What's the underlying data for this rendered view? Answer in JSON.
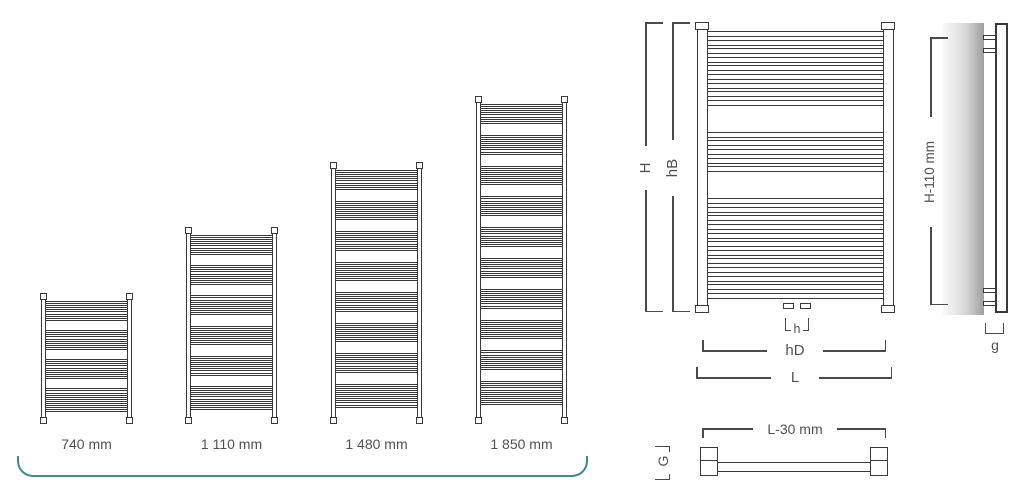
{
  "palette": {
    "line": "#39393b",
    "dim": "#4a4b4d",
    "label": "#505254",
    "teal": "#41898e",
    "wall_light": "#fbfbfb",
    "wall_dark": "#9e9e9e"
  },
  "lineup": {
    "baseline_y": 424,
    "label_y": 436,
    "bracket": {
      "x": 17,
      "y": 456,
      "width": 571,
      "height": 21
    },
    "style": {
      "cap_w": 7,
      "cap_h": 7,
      "rail_w": 5,
      "tube_h": 3,
      "tube_gap": 1.2
    },
    "radiators": [
      {
        "label": "740 mm",
        "x": 40,
        "width": 93,
        "height": 131,
        "groups": [
          5,
          5,
          5,
          6
        ]
      },
      {
        "label": "1 110 mm",
        "x": 185,
        "width": 93,
        "height": 197,
        "groups": [
          5,
          5,
          5,
          5,
          5,
          6
        ]
      },
      {
        "label": "1 480 mm",
        "x": 330,
        "width": 93,
        "height": 262,
        "groups": [
          5,
          5,
          5,
          5,
          5,
          5,
          5,
          6
        ]
      },
      {
        "label": "1 850 mm",
        "x": 475,
        "width": 93,
        "height": 328,
        "groups": [
          5,
          5,
          5,
          5,
          5,
          5,
          5,
          5,
          5,
          6
        ]
      }
    ]
  },
  "front_view": {
    "figure": {
      "x": 695,
      "y": 22,
      "width": 200,
      "height": 291,
      "groups": [
        9,
        5,
        12
      ]
    },
    "style": {
      "cap_w": 14,
      "cap_h": 8,
      "rail_w": 11,
      "tube_h": 6,
      "tube_gap": 2.6
    },
    "dims": {
      "H": "H",
      "hB": "hB",
      "h": "h",
      "hD": "hD",
      "L": "L"
    }
  },
  "side_view": {
    "dims": {
      "height": "H-110 mm",
      "gap": "g"
    }
  },
  "plan_view": {
    "dims": {
      "length": "L-30 mm",
      "depth": "G"
    }
  }
}
